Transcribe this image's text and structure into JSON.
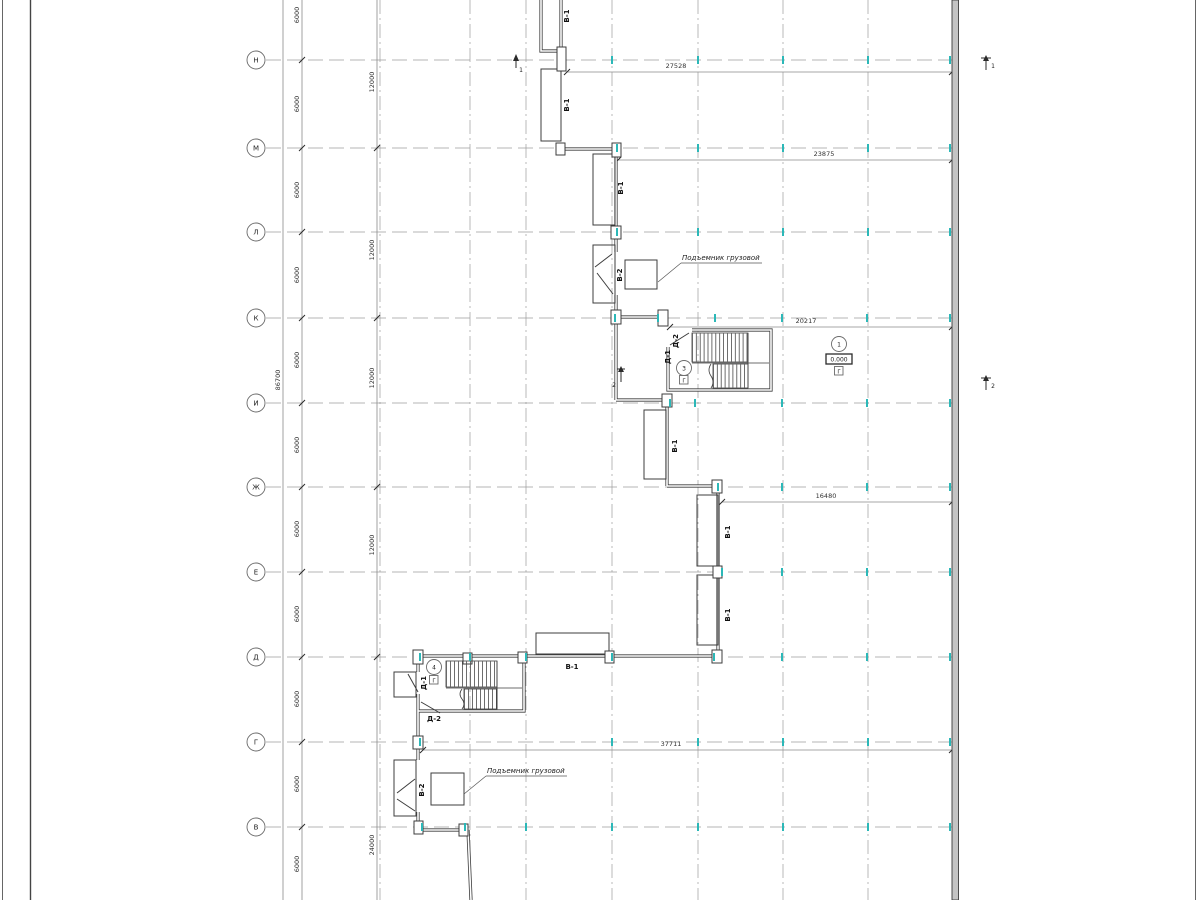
{
  "drawing_type": "architectural floor plan (Russian CAD sheet)",
  "colors": {
    "line": "#3c3c3c",
    "grid": "#9d9d9d",
    "dim": "#8a8a8a",
    "accent": "#2cb8b8",
    "wallfill": "#c4c4c4"
  },
  "grid_rows": [
    "Н",
    "М",
    "Л",
    "К",
    "И",
    "Ж",
    "Е",
    "Д",
    "Г",
    "В"
  ],
  "dims": {
    "overall_height": "86700",
    "seg6000": [
      "6000",
      "6000",
      "6000",
      "6000",
      "6000",
      "6000",
      "6000",
      "6000",
      "6000",
      "6000",
      "6000"
    ],
    "seg12000": [
      "12000",
      "12000",
      "12000",
      "12000"
    ],
    "seg24000": "24000",
    "top_width": "27528",
    "width_row_m": "23875",
    "width_row_k": "20217",
    "width_row_zh": "16480",
    "width_row_g": "37711"
  },
  "gate_marks": [
    "В-1",
    "В-1",
    "В-1",
    "В-1",
    "В-1",
    "В-1",
    "В-1"
  ],
  "lift_marks": [
    "В-2",
    "В-2"
  ],
  "door_marks_top_stair": [
    "Д-2",
    "Д-1"
  ],
  "door_marks_bottom_stair": [
    "Д-1",
    "Д-2"
  ],
  "notes": {
    "lift_label_top": "Подъемник грузовой",
    "lift_label_bottom": "Подъемник грузовой"
  },
  "nodes": {
    "stair_top_num": "3",
    "stair_bottom_num": "4",
    "elevation_node_num": "1",
    "elevation_value": "0.000",
    "category_marks": [
      "Г",
      "Г",
      "Г"
    ]
  },
  "sections": {
    "cut1": "1",
    "cut2": "2"
  }
}
